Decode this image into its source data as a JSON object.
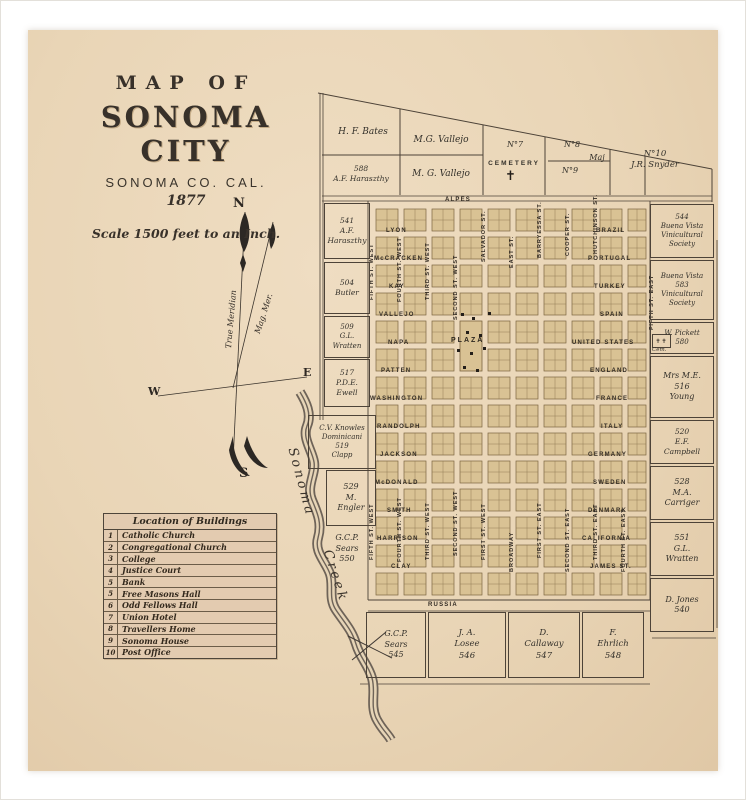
{
  "title_block": {
    "line1": "MAP OF",
    "line2": "SONOMA CITY",
    "line3": "SONOMA CO. CAL.",
    "line4": "1877",
    "scale": "Scale 1500 feet to an Inch."
  },
  "compass": {
    "n": "N",
    "s": "S",
    "e": "E",
    "w": "W",
    "true_meridian": "True Meridian",
    "magnetic": "Mag. Mer."
  },
  "creek": {
    "word1": "Sonoma",
    "word2": "Creek"
  },
  "legend": {
    "title": "Location of Buildings",
    "rows": [
      {
        "num": "1",
        "name": "Catholic Church"
      },
      {
        "num": "2",
        "name": "Congregational Church"
      },
      {
        "num": "3",
        "name": "College"
      },
      {
        "num": "4",
        "name": "Justice Court"
      },
      {
        "num": "5",
        "name": "Bank"
      },
      {
        "num": "5",
        "name": "Free Masons Hall"
      },
      {
        "num": "6",
        "name": "Odd Fellows Hall"
      },
      {
        "num": "7",
        "name": "Union Hotel"
      },
      {
        "num": "8",
        "name": "Travellers Home"
      },
      {
        "num": "9",
        "name": "Sonoma House"
      },
      {
        "num": "10",
        "name": "Post Office"
      }
    ]
  },
  "map": {
    "plaza": "PLAZA",
    "cem_label": "Cem.",
    "colors": {
      "block": "#d9c294",
      "block_line": "#7b6440",
      "ink": "#352e26",
      "boundary": "#4d4338"
    },
    "streets_horizontal": [
      {
        "name": "ALPES",
        "x": 445,
        "y": 197
      },
      {
        "name": "LYON",
        "x": 386,
        "y": 228
      },
      {
        "name": "McCRACKEN",
        "x": 374,
        "y": 256
      },
      {
        "name": "KAY",
        "x": 389,
        "y": 284
      },
      {
        "name": "VALLEJO",
        "x": 379,
        "y": 312
      },
      {
        "name": "NAPA",
        "x": 388,
        "y": 340
      },
      {
        "name": "PATTEN",
        "x": 381,
        "y": 368
      },
      {
        "name": "WASHINGTON",
        "x": 370,
        "y": 396
      },
      {
        "name": "RANDOLPH",
        "x": 377,
        "y": 424
      },
      {
        "name": "JACKSON",
        "x": 380,
        "y": 452
      },
      {
        "name": "McDONALD",
        "x": 375,
        "y": 480
      },
      {
        "name": "SMITH",
        "x": 387,
        "y": 508
      },
      {
        "name": "HARRISON",
        "x": 377,
        "y": 536
      },
      {
        "name": "CLAY",
        "x": 391,
        "y": 564
      },
      {
        "name": "RUSSIA",
        "x": 428,
        "y": 602
      },
      {
        "name": "BRAZIL",
        "x": 596,
        "y": 228
      },
      {
        "name": "PORTUGAL",
        "x": 588,
        "y": 256
      },
      {
        "name": "TURKEY",
        "x": 594,
        "y": 284
      },
      {
        "name": "SPAIN",
        "x": 600,
        "y": 312
      },
      {
        "name": "UNITED STATES",
        "x": 572,
        "y": 340
      },
      {
        "name": "ENGLAND",
        "x": 590,
        "y": 368
      },
      {
        "name": "FRANCE",
        "x": 596,
        "y": 396
      },
      {
        "name": "ITALY",
        "x": 601,
        "y": 424
      },
      {
        "name": "GERMANY",
        "x": 588,
        "y": 452
      },
      {
        "name": "SWEDEN",
        "x": 593,
        "y": 480
      },
      {
        "name": "DENMARK",
        "x": 588,
        "y": 508
      },
      {
        "name": "CALIFORNIA",
        "x": 582,
        "y": 536
      },
      {
        "name": "JAMES ST.",
        "x": 590,
        "y": 564
      }
    ],
    "streets_vertical": [
      {
        "name": "FIFTH ST. WEST",
        "x": 372,
        "y": 300
      },
      {
        "name": "FOURTH ST. WEST",
        "x": 400,
        "y": 302
      },
      {
        "name": "THIRD ST. WEST",
        "x": 428,
        "y": 300
      },
      {
        "name": "SECOND ST. WEST",
        "x": 456,
        "y": 320
      },
      {
        "name": "FIFTH ST. WEST",
        "x": 372,
        "y": 560
      },
      {
        "name": "FOURTH ST. WEST",
        "x": 400,
        "y": 562
      },
      {
        "name": "THIRD ST. WEST",
        "x": 428,
        "y": 560
      },
      {
        "name": "SECOND ST. WEST",
        "x": 456,
        "y": 556
      },
      {
        "name": "FIRST ST. WEST",
        "x": 484,
        "y": 560
      },
      {
        "name": "BROADWAY",
        "x": 512,
        "y": 572
      },
      {
        "name": "FIRST ST. EAST",
        "x": 540,
        "y": 558
      },
      {
        "name": "SECOND ST. EAST",
        "x": 568,
        "y": 572
      },
      {
        "name": "THIRD ST. EAST",
        "x": 596,
        "y": 560
      },
      {
        "name": "FOURTH ST. EAST",
        "x": 624,
        "y": 572
      },
      {
        "name": "FIFTH ST. EAST",
        "x": 652,
        "y": 330
      },
      {
        "name": "SALVADOR ST.",
        "x": 484,
        "y": 262
      },
      {
        "name": "EAST ST.",
        "x": 512,
        "y": 268
      },
      {
        "name": "BARRYESSA ST.",
        "x": 540,
        "y": 258
      },
      {
        "name": "COOPER ST.",
        "x": 568,
        "y": 256
      },
      {
        "name": "HUTCHINSON ST.",
        "x": 596,
        "y": 254
      }
    ],
    "parcels": [
      {
        "lines": [
          "H. F. Bates"
        ],
        "x": 330,
        "y": 118,
        "w": 66,
        "h": 30,
        "box": false,
        "fs": 9
      },
      {
        "lines": [
          "M.G. Vallejo"
        ],
        "x": 402,
        "y": 126,
        "w": 78,
        "h": 30,
        "box": false,
        "fs": 9
      },
      {
        "lines": [
          "588",
          "A.F. Haraszthy"
        ],
        "x": 324,
        "y": 155,
        "w": 74,
        "h": 38,
        "box": false,
        "fs": 7.5
      },
      {
        "lines": [
          "M. G. Vallejo"
        ],
        "x": 402,
        "y": 158,
        "w": 78,
        "h": 34,
        "box": false,
        "fs": 9
      },
      {
        "lines": [
          "N°7"
        ],
        "x": 495,
        "y": 138,
        "w": 40,
        "h": 14,
        "box": false,
        "fs": 8
      },
      {
        "lines": [
          "CEMETERY"
        ],
        "x": 484,
        "y": 158,
        "w": 60,
        "h": 12,
        "box": false,
        "fs": 6.5,
        "caps": true
      },
      {
        "lines": [
          "N°8"
        ],
        "x": 552,
        "y": 138,
        "w": 40,
        "h": 14,
        "box": false,
        "fs": 8
      },
      {
        "lines": [
          "Maj"
        ],
        "x": 585,
        "y": 152,
        "w": 24,
        "h": 12,
        "box": false,
        "fs": 8
      },
      {
        "lines": [
          "N°9"
        ],
        "x": 550,
        "y": 164,
        "w": 40,
        "h": 14,
        "box": false,
        "fs": 8
      },
      {
        "lines": [
          "N°10",
          "J.R. Snyder"
        ],
        "x": 612,
        "y": 144,
        "w": 86,
        "h": 32,
        "box": false,
        "fs": 8.5
      },
      {
        "lines": [
          "541",
          "A.F.",
          "Haraszthy"
        ],
        "x": 324,
        "y": 203,
        "w": 44,
        "h": 54,
        "box": true,
        "fs": 7.5
      },
      {
        "lines": [
          "504",
          "Butler"
        ],
        "x": 324,
        "y": 262,
        "w": 44,
        "h": 50,
        "box": true,
        "fs": 7.5
      },
      {
        "lines": [
          "509",
          "G.L.",
          "Wratten"
        ],
        "x": 324,
        "y": 316,
        "w": 44,
        "h": 40,
        "box": true,
        "fs": 7
      },
      {
        "lines": [
          "517",
          "P.D.E.",
          "Ewell"
        ],
        "x": 324,
        "y": 359,
        "w": 44,
        "h": 46,
        "box": true,
        "fs": 7.5
      },
      {
        "lines": [
          "C.V. Knowles",
          "Dominicani",
          "519",
          "Clapp"
        ],
        "x": 308,
        "y": 415,
        "w": 66,
        "h": 52,
        "box": true,
        "fs": 7
      },
      {
        "lines": [
          "529",
          "M.",
          "Engler"
        ],
        "x": 326,
        "y": 470,
        "w": 48,
        "h": 54,
        "box": true,
        "fs": 8
      },
      {
        "lines": [
          "G.C.P.",
          "Sears",
          "550"
        ],
        "x": 324,
        "y": 528,
        "w": 46,
        "h": 42,
        "box": false,
        "fs": 8
      },
      {
        "lines": [
          "544",
          "Buena Vista",
          "Vinicultural",
          "Society"
        ],
        "x": 650,
        "y": 204,
        "w": 62,
        "h": 52,
        "box": true,
        "fs": 7
      },
      {
        "lines": [
          "Buena Vista",
          "583",
          "Vinicultural",
          "Society"
        ],
        "x": 650,
        "y": 260,
        "w": 62,
        "h": 58,
        "box": true,
        "fs": 7
      },
      {
        "lines": [
          "W. Pickett",
          "580"
        ],
        "x": 650,
        "y": 322,
        "w": 62,
        "h": 30,
        "box": true,
        "fs": 7
      },
      {
        "lines": [
          "Mrs M.E.",
          "516",
          "Young"
        ],
        "x": 650,
        "y": 356,
        "w": 62,
        "h": 60,
        "box": true,
        "fs": 8
      },
      {
        "lines": [
          "520",
          "E.F.",
          "Campbell"
        ],
        "x": 650,
        "y": 420,
        "w": 62,
        "h": 42,
        "box": true,
        "fs": 7.5
      },
      {
        "lines": [
          "528",
          "M.A.",
          "Carriger"
        ],
        "x": 650,
        "y": 466,
        "w": 62,
        "h": 52,
        "box": true,
        "fs": 8
      },
      {
        "lines": [
          "551",
          "G.L.",
          "Wratten"
        ],
        "x": 650,
        "y": 522,
        "w": 62,
        "h": 52,
        "box": true,
        "fs": 8
      },
      {
        "lines": [
          "D. Jones",
          "540"
        ],
        "x": 650,
        "y": 578,
        "w": 62,
        "h": 52,
        "box": true,
        "fs": 8
      },
      {
        "lines": [
          "G.C.P.",
          "Sears",
          "545"
        ],
        "x": 366,
        "y": 612,
        "w": 58,
        "h": 64,
        "box": true,
        "fs": 8
      },
      {
        "lines": [
          "J. A.",
          "Losee",
          "546"
        ],
        "x": 428,
        "y": 612,
        "w": 76,
        "h": 64,
        "box": true,
        "fs": 8.5
      },
      {
        "lines": [
          "D.",
          "Callaway",
          "547"
        ],
        "x": 508,
        "y": 612,
        "w": 70,
        "h": 64,
        "box": true,
        "fs": 8.5
      },
      {
        "lines": [
          "F.",
          "Ehrlich",
          "548"
        ],
        "x": 582,
        "y": 612,
        "w": 60,
        "h": 64,
        "box": true,
        "fs": 8.5
      }
    ],
    "building_markers": [
      {
        "x": 461,
        "y": 313
      },
      {
        "x": 472,
        "y": 317
      },
      {
        "x": 466,
        "y": 331
      },
      {
        "x": 479,
        "y": 334
      },
      {
        "x": 457,
        "y": 349
      },
      {
        "x": 470,
        "y": 352
      },
      {
        "x": 483,
        "y": 347
      },
      {
        "x": 463,
        "y": 366
      },
      {
        "x": 476,
        "y": 369
      },
      {
        "x": 488,
        "y": 312
      }
    ]
  }
}
